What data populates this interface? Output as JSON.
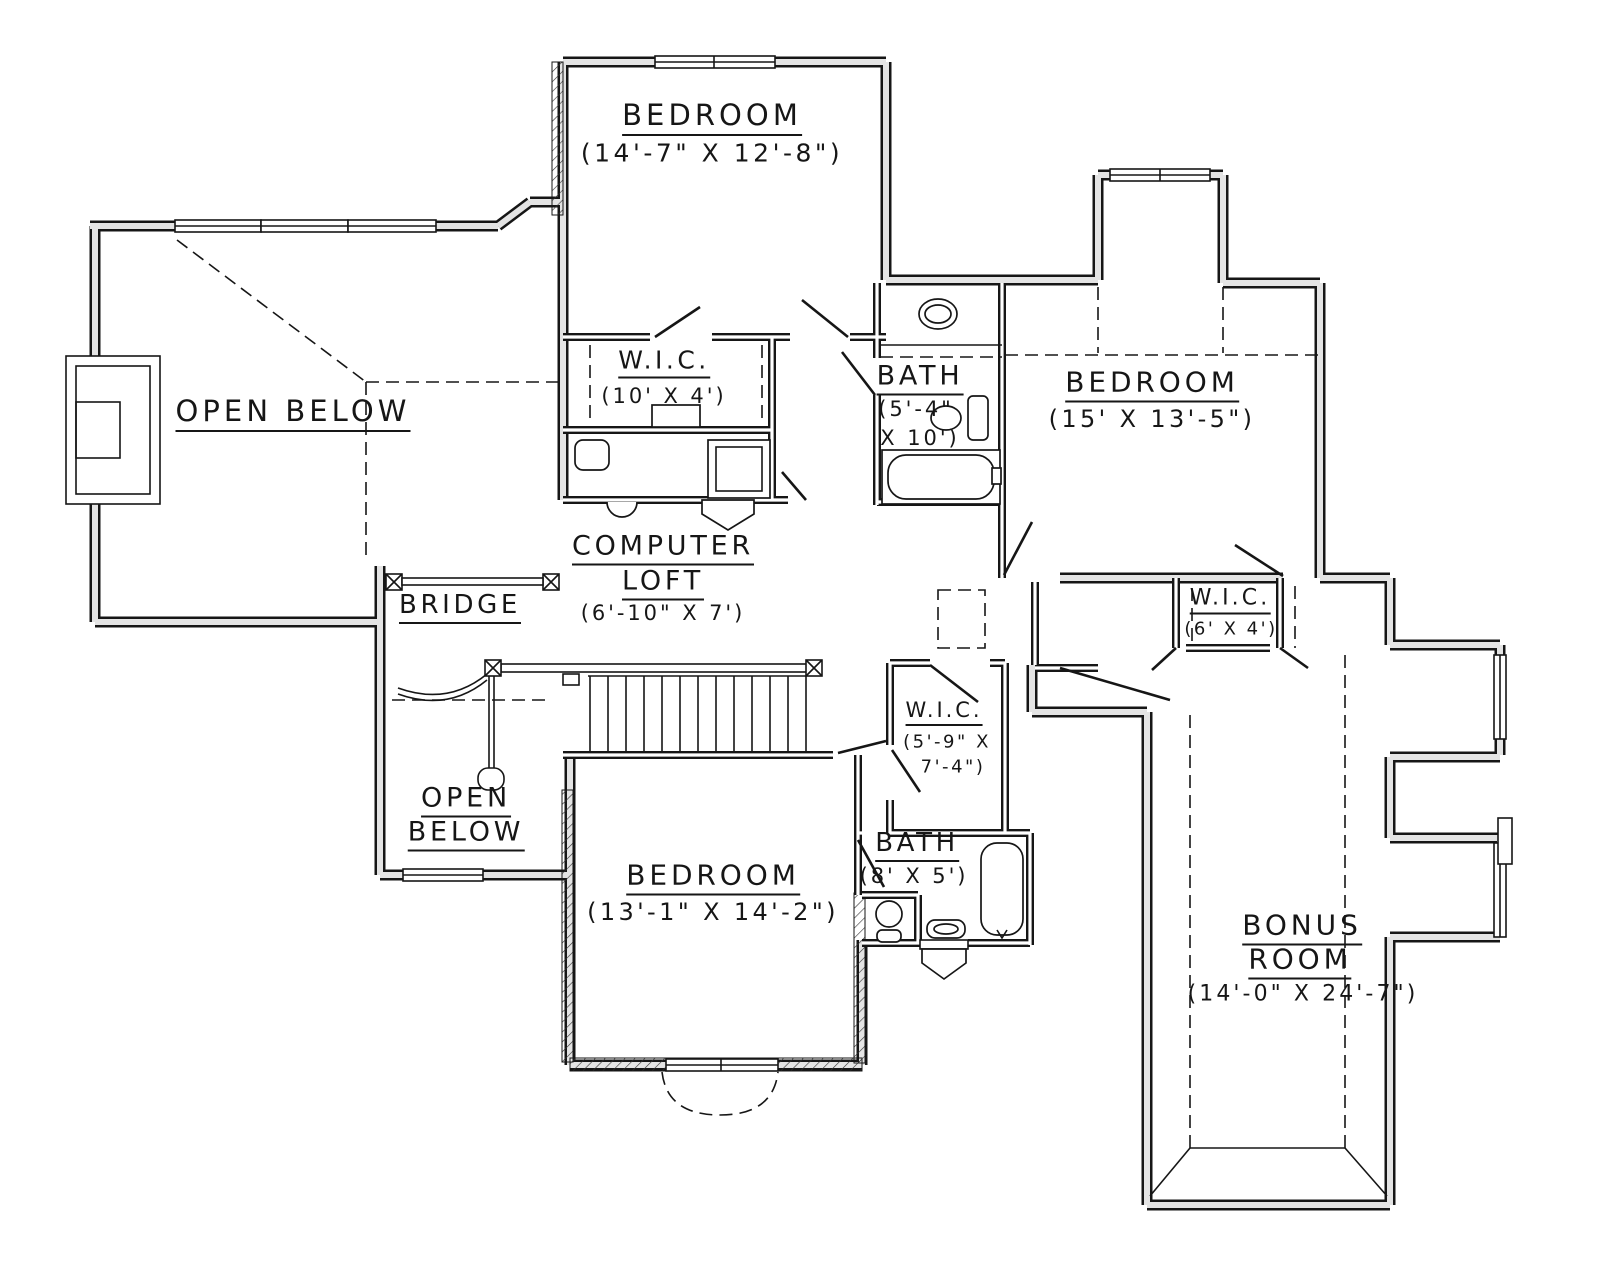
{
  "colors": {
    "background": "#ffffff",
    "line": "#161616",
    "wall_fill": "#e4e4e4"
  },
  "plan": {
    "type": "architectural-floor-plan",
    "rooms": [
      {
        "id": "bedroom-top",
        "name": "BEDROOM",
        "dims": "(14'-7\" X 12'-8\")"
      },
      {
        "id": "open-below-left",
        "name": "OPEN BELOW"
      },
      {
        "id": "wic-top",
        "name": "W.I.C.",
        "dims": "(10' X 4')"
      },
      {
        "id": "bath-top",
        "name": "BATH",
        "dims_line1": "(5'-4\"",
        "dims_line2": "X 10')"
      },
      {
        "id": "bedroom-right",
        "name": "BEDROOM",
        "dims": "(15' X 13'-5\")"
      },
      {
        "id": "computer-loft",
        "name_line1": "COMPUTER",
        "name_line2": "LOFT",
        "dims": "(6'-10\" X 7')"
      },
      {
        "id": "bridge",
        "name": "BRIDGE"
      },
      {
        "id": "wic-right",
        "name": "W.I.C.",
        "dims": "(6' X 4')"
      },
      {
        "id": "wic-middle",
        "name": "W.I.C.",
        "dims_line1": "(5'-9\" X",
        "dims_line2": "7'-4\")"
      },
      {
        "id": "open-below-bottom",
        "name_line1": "OPEN",
        "name_line2": "BELOW"
      },
      {
        "id": "bedroom-bottom",
        "name": "BEDROOM",
        "dims": "(13'-1\" X 14'-2\")"
      },
      {
        "id": "bath-bottom",
        "name": "BATH",
        "dims": "(8' X 5')"
      },
      {
        "id": "bonus-room",
        "name_line1": "BONUS",
        "name_line2": "ROOM",
        "dims": "(14'-0\" X 24'-7\")"
      }
    ]
  }
}
